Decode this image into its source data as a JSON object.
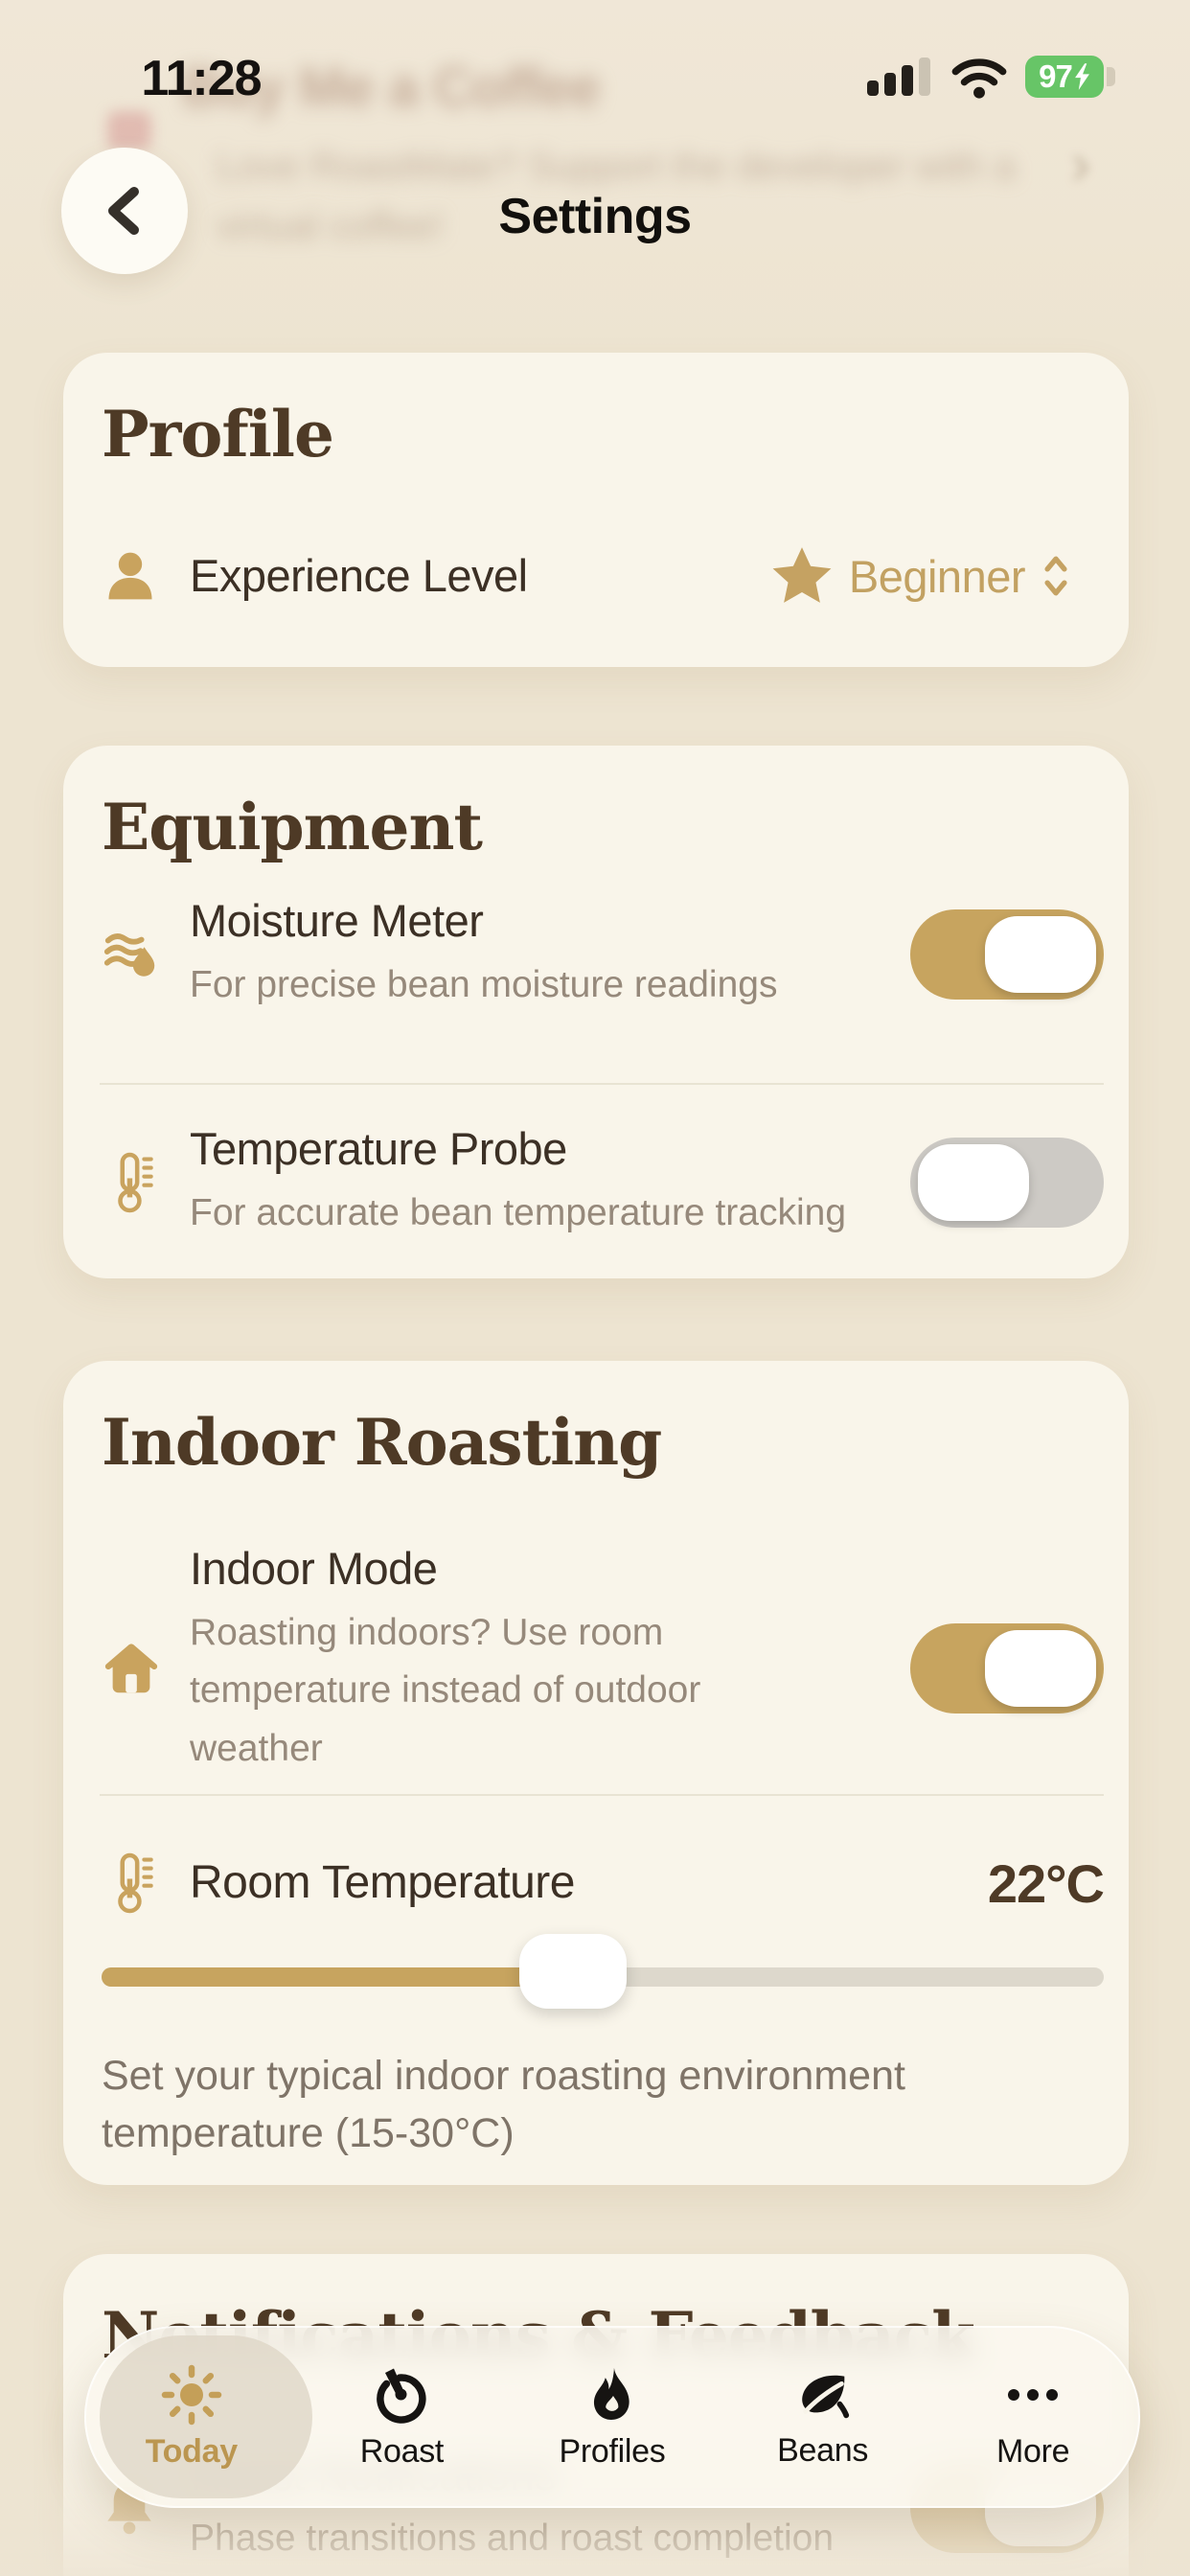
{
  "status_bar": {
    "time": "11:28",
    "battery_percent": "97"
  },
  "header": {
    "title": "Settings"
  },
  "background_content": {
    "top_card": {
      "title": "Buy Me a Coffee",
      "line1": "Love RoastMate? Support the developer with a",
      "line2": "virtual coffee!",
      "chevron": "›"
    },
    "bottom_card": {
      "heading": "Notifications & Feedback",
      "row_title": "Roast Notifications",
      "row_subtitle": "Phase transitions and roast completion",
      "toggle_on": true
    }
  },
  "profile_card": {
    "heading": "Profile",
    "experience": {
      "label": "Experience Level",
      "value": "Beginner"
    }
  },
  "equipment_card": {
    "heading": "Equipment",
    "moisture": {
      "title": "Moisture Meter",
      "subtitle": "For precise bean moisture readings",
      "enabled": true
    },
    "probe": {
      "title": "Temperature Probe",
      "subtitle": "For accurate bean temperature tracking",
      "enabled": false
    }
  },
  "indoor_card": {
    "heading": "Indoor Roasting",
    "indoor_mode": {
      "title": "Indoor Mode",
      "subtitle": "Roasting indoors? Use room temperature instead of outdoor weather",
      "enabled": true
    },
    "room_temp": {
      "label": "Room Temperature",
      "value": "22°C",
      "slider_percent": 47,
      "caption": "Set your typical indoor roasting environment temperature (15-30°C)"
    }
  },
  "tab_bar": {
    "tabs": [
      {
        "label": "Today",
        "active": true
      },
      {
        "label": "Roast",
        "active": false
      },
      {
        "label": "Profiles",
        "active": false
      },
      {
        "label": "Beans",
        "active": false
      },
      {
        "label": "More",
        "active": false
      }
    ]
  },
  "colors": {
    "accent_gold": "#C7A45F",
    "heading_brown": "#4E3A26",
    "page_background": "#EDE4D1",
    "card_background": "#F9F5EA",
    "battery_green": "#67C567",
    "toggle_off_gray": "#CDCAC5"
  }
}
